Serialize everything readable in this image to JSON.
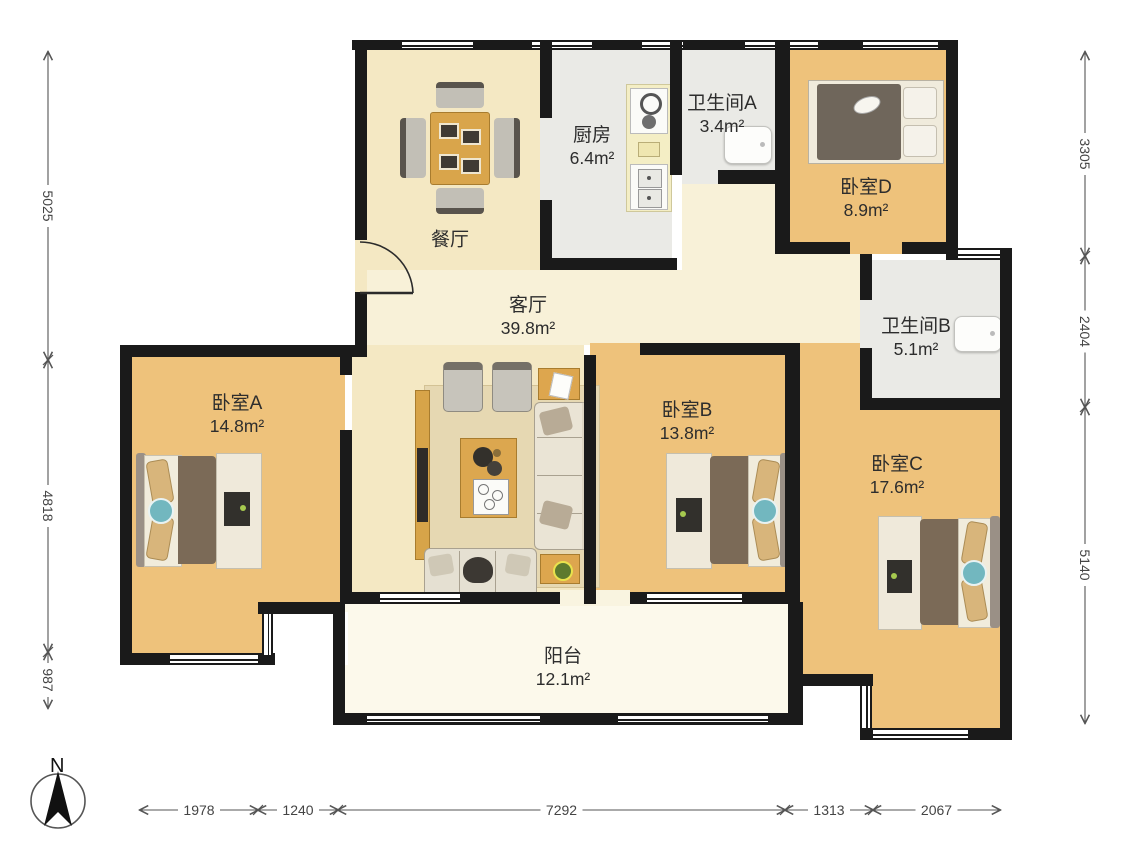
{
  "plan": {
    "north_label": "N",
    "rooms": [
      {
        "id": "dining",
        "name": "餐厅",
        "area": "",
        "cx": 450,
        "cy": 240
      },
      {
        "id": "kitchen",
        "name": "厨房",
        "area": "6.4m²",
        "cx": 592,
        "cy": 147
      },
      {
        "id": "bath-a",
        "name": "卫生间A",
        "area": "3.4m²",
        "cx": 722,
        "cy": 115
      },
      {
        "id": "bed-d",
        "name": "卧室D",
        "area": "8.9m²",
        "cx": 866,
        "cy": 199
      },
      {
        "id": "living",
        "name": "客厅",
        "area": "39.8m²",
        "cx": 528,
        "cy": 317
      },
      {
        "id": "bath-b",
        "name": "卫生间B",
        "area": "5.1m²",
        "cx": 916,
        "cy": 338
      },
      {
        "id": "bed-a",
        "name": "卧室A",
        "area": "14.8m²",
        "cx": 237,
        "cy": 415
      },
      {
        "id": "bed-b",
        "name": "卧室B",
        "area": "13.8m²",
        "cx": 687,
        "cy": 422
      },
      {
        "id": "bed-c",
        "name": "卧室C",
        "area": "17.6m²",
        "cx": 897,
        "cy": 476
      },
      {
        "id": "balcony",
        "name": "阳台",
        "area": "12.1m²",
        "cx": 563,
        "cy": 668
      }
    ],
    "dimensions": {
      "left": {
        "axis": "v",
        "pos": 48,
        "segments": [
          {
            "label": "5025",
            "from": 52,
            "to": 360
          },
          {
            "label": "4818",
            "from": 360,
            "to": 652
          },
          {
            "label": "987",
            "from": 652,
            "to": 708
          }
        ]
      },
      "right": {
        "axis": "v",
        "pos": 1085,
        "segments": [
          {
            "label": "3305",
            "from": 52,
            "to": 256
          },
          {
            "label": "2404",
            "from": 256,
            "to": 407
          },
          {
            "label": "5140",
            "from": 407,
            "to": 723
          }
        ]
      },
      "bottom": {
        "axis": "h",
        "pos": 810,
        "segments": [
          {
            "label": "1978",
            "from": 140,
            "to": 258
          },
          {
            "label": "1240",
            "from": 258,
            "to": 338
          },
          {
            "label": "7292",
            "from": 338,
            "to": 785
          },
          {
            "label": "1313",
            "from": 785,
            "to": 873
          },
          {
            "label": "2067",
            "from": 873,
            "to": 1000
          }
        ]
      }
    },
    "colors": {
      "wall": "#1a1a1a",
      "wood": "#eec27b",
      "cream": "#f4e8c3",
      "hall": "#f8f1d8",
      "tile": "#eaeae6",
      "balcony": "#fcf9eb",
      "rug": "#e6d8b2",
      "table_wood": "#d9a54b",
      "duvet": "#7b6a57",
      "teal": "#72b7bf",
      "pillow_tan": "#d8b57b",
      "dim_line": "#555555"
    }
  }
}
